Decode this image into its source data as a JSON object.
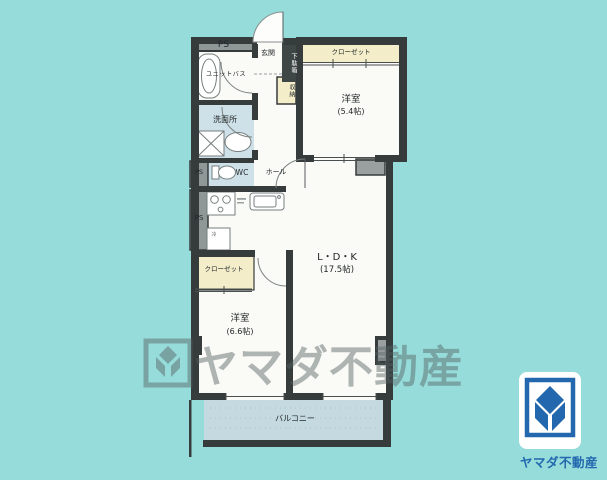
{
  "page": {
    "background_color": "#96dcda"
  },
  "plan": {
    "labels": {
      "ps_top": "PS",
      "unit_bath": "ユニットバス",
      "entrance": "玄関",
      "shoe_cabinet": "下駄箱",
      "closet_top": "クローゼット",
      "bedroom1_name": "洋室",
      "bedroom1_size": "(5.4帖)",
      "washroom": "洗面所",
      "storage": "収納",
      "ps_mid": "PS",
      "toilet": "WC",
      "hall": "ホール",
      "ps_lower": "PS",
      "fridge": "冷",
      "ldk_name": "L・D・K",
      "ldk_size": "(17.5帖)",
      "closet_lower": "クローゼット",
      "bedroom2_name": "洋室",
      "bedroom2_size": "(6.6帖)",
      "balcony": "バルコニー"
    },
    "colors": {
      "wall": "#363c3c",
      "room_white": "#fafaf6",
      "closet_cream": "#f3edca",
      "wet_room_blue": "#cfe1e8",
      "balcony_blue": "#c5d9e0",
      "duct_gray": "#8f9797"
    }
  },
  "watermark": {
    "text": "ヤマダ不動産"
  },
  "logo": {
    "text": "ヤマダ不動産",
    "color": "#2368ae"
  }
}
